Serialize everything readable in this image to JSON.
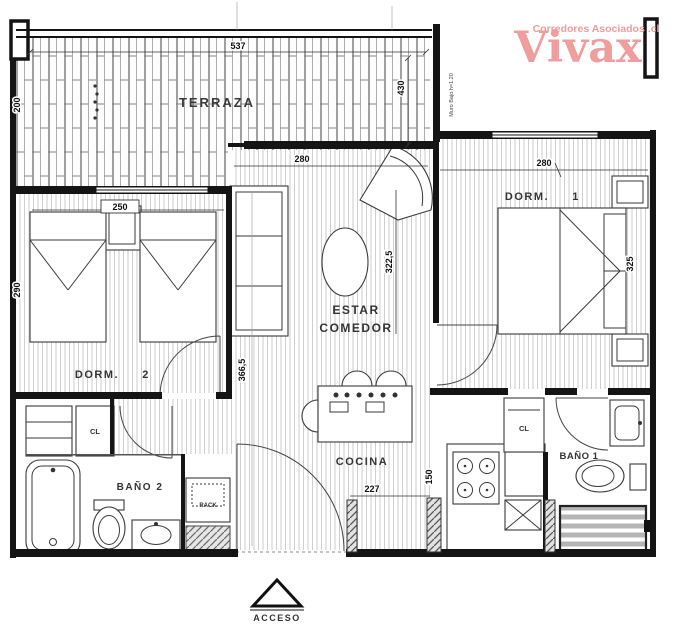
{
  "logo": {
    "brand": "Vivax",
    "tagline": "Corredores Asociados .cl",
    "color": "#ef9d9d"
  },
  "rooms": {
    "terraza": "TERRAZA",
    "dorm2_label": "DORM.",
    "dorm2_num": "2",
    "dorm1_label": "DORM.",
    "dorm1_num": "1",
    "estar1": "ESTAR",
    "estar2": "COMEDOR",
    "cocina": "COCINA",
    "bano2": "BAÑO 2",
    "bano1": "BAÑO 1",
    "acceso": "ACCESO",
    "closet": "CL",
    "rack": "RACK"
  },
  "dims": {
    "terraza_w": "537",
    "terraza_h": "200",
    "terraza_r": "430",
    "dorm2_w": "250",
    "dorm2_h": "290",
    "estar_w": "280",
    "estar_h": "322,5",
    "estar_h2": "366,5",
    "dorm1_w": "280",
    "dorm1_h": "325",
    "cocina_w": "227",
    "cocina_h": "150"
  },
  "notes": {
    "muro_bajo": "Muro Bajo h=1.20"
  }
}
